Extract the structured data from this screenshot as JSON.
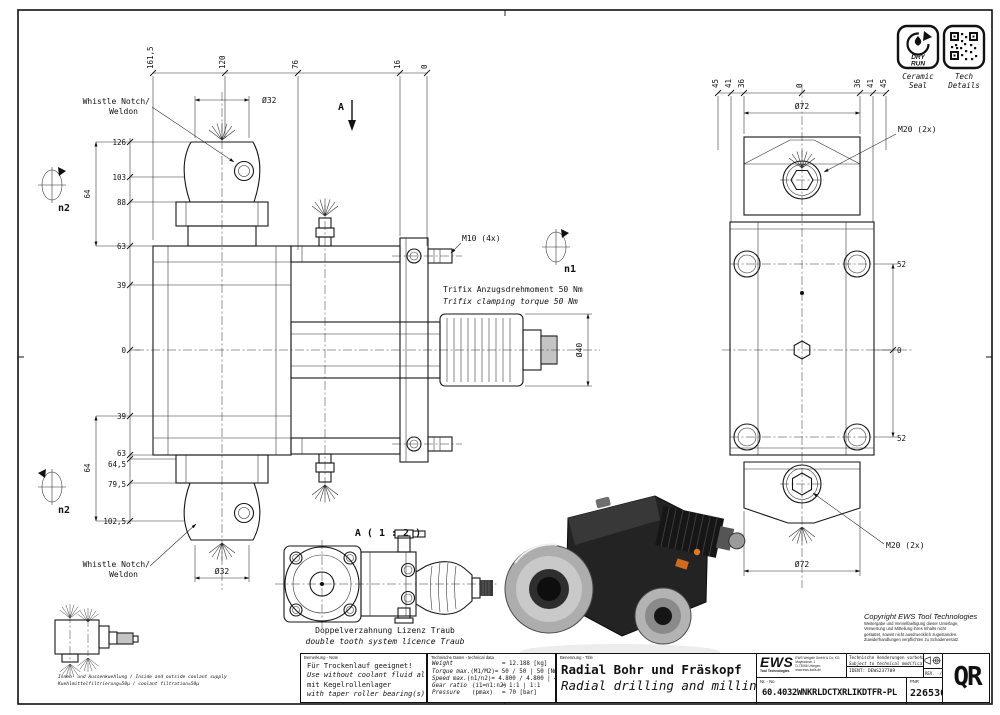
{
  "badges": {
    "dry": "DRY",
    "run": "RUN",
    "ceramic_caption1": "Ceramic",
    "ceramic_caption2": "Seal",
    "tech_caption1": "Tech",
    "tech_caption2": "Details"
  },
  "front_view": {
    "top_dims": [
      "161,5",
      "120",
      "76",
      "16",
      "0"
    ],
    "left_dims": [
      "126",
      "103",
      "88",
      "63",
      "39",
      "0",
      "39",
      "63",
      "64,5",
      "79,5",
      "102,5"
    ],
    "span_upper": "64",
    "span_lower": "64",
    "dia_top": "Ø32",
    "dia_bottom": "Ø32",
    "dia_shaft": "Ø40",
    "section_label": "A",
    "whistle_top_line1": "Whistle Notch/",
    "whistle_top_line2": "Weldon",
    "whistle_bottom_line1": "Whistle Notch/",
    "whistle_bottom_line2": "Weldon",
    "m10_label": "M10 (4x)",
    "trifix_de": "Trifix Anzugsdrehmoment  50 Nm",
    "trifix_en": "Trifix clamping torque  50 Nm",
    "n1_label": "n1",
    "n2_upper_label": "n2",
    "n2_lower_label": "n2"
  },
  "side_view": {
    "top_dims": [
      "45",
      "41",
      "36",
      "0",
      "36",
      "41",
      "45"
    ],
    "dia_top": "Ø72",
    "dia_bottom": "Ø72",
    "m20_top": "M20 (2x)",
    "m20_bottom": "M20 (2x)",
    "right_dims": [
      "52",
      "0",
      "52"
    ]
  },
  "detail_view": {
    "title": "A ( 1 : 2 )",
    "caption_de": "Doppelverzahnung Lizenz Traub",
    "caption_en": "double tooth system licence Traub"
  },
  "coolant_note": {
    "line1": "Innen- und Aussenkuehlung / Inside and outside coolant supply",
    "line2": "Kuehlmittelfiltrierung=50µ / coolant filtration=50µ"
  },
  "remark_block": {
    "header": "Bemerkung - Note",
    "line1": "Für Trockenlauf geeignet!",
    "line2": "Use without coolant fluid allowed!",
    "line3": "mit Kegelrollenlager",
    "line4": "with taper roller bearing(s)"
  },
  "tech_data": {
    "header": "Technische Daten - technical data",
    "rows": [
      {
        "label": "Weight",
        "param": "",
        "value": "= 12.188 [kg]"
      },
      {
        "label": "Torque max.",
        "param": "(M1/M2)",
        "value": "= 50 / 50 | 50 [Nm]"
      },
      {
        "label": "Speed max.",
        "param": "(n1/n2)",
        "value": "= 4.800 / 4.800 | 4.800 [1/min]"
      },
      {
        "label": "Gear ratio",
        "param": "(i1=n1:n2)",
        "value": "= 1:1 | 1:1"
      },
      {
        "label": "Pressure",
        "param": "(pmax)",
        "value": "= 70 [bar]"
      }
    ]
  },
  "title_block": {
    "name_header": "Benennung - Title",
    "title_de": "Radial Bohr und Fräskopf",
    "title_en": "Radial drilling and milling head",
    "logo_text": "EWS",
    "logo_sub": "Tool Technologies",
    "address_line1": "EWS Weigele GmbH & Co. KG",
    "address_line2": "Maybachstr. 1",
    "address_line3": "D-73066 Uhingen",
    "address_line4": "www.ews-tools.de",
    "notice_de": "Technische Aenderungen vorbehalten!",
    "notice_en": "Subject to technical modifications!",
    "ident": "IDENT:  DEWS237709",
    "rev": "REV. -/C",
    "nr_header": "Nr. - No",
    "part_number": "60.4032WNKRLDCTXRLIKDTFR-PL",
    "pnr_header": "PNR",
    "pnr_value": "226530",
    "qr_label": "QR"
  },
  "copyright": {
    "line1": "Copyright EWS Tool Technologies",
    "line2": "Weitergabe und Vervielfaeltigung dieser Unterlage,",
    "line3": "Verwertung und Mitteilung ihres Inhalts nicht",
    "line4": "gestattet, soweit nicht ausdruecklich zugestanden.",
    "line5": "Zuwiderhandlungen verpflichten zu Schadenersatz."
  }
}
